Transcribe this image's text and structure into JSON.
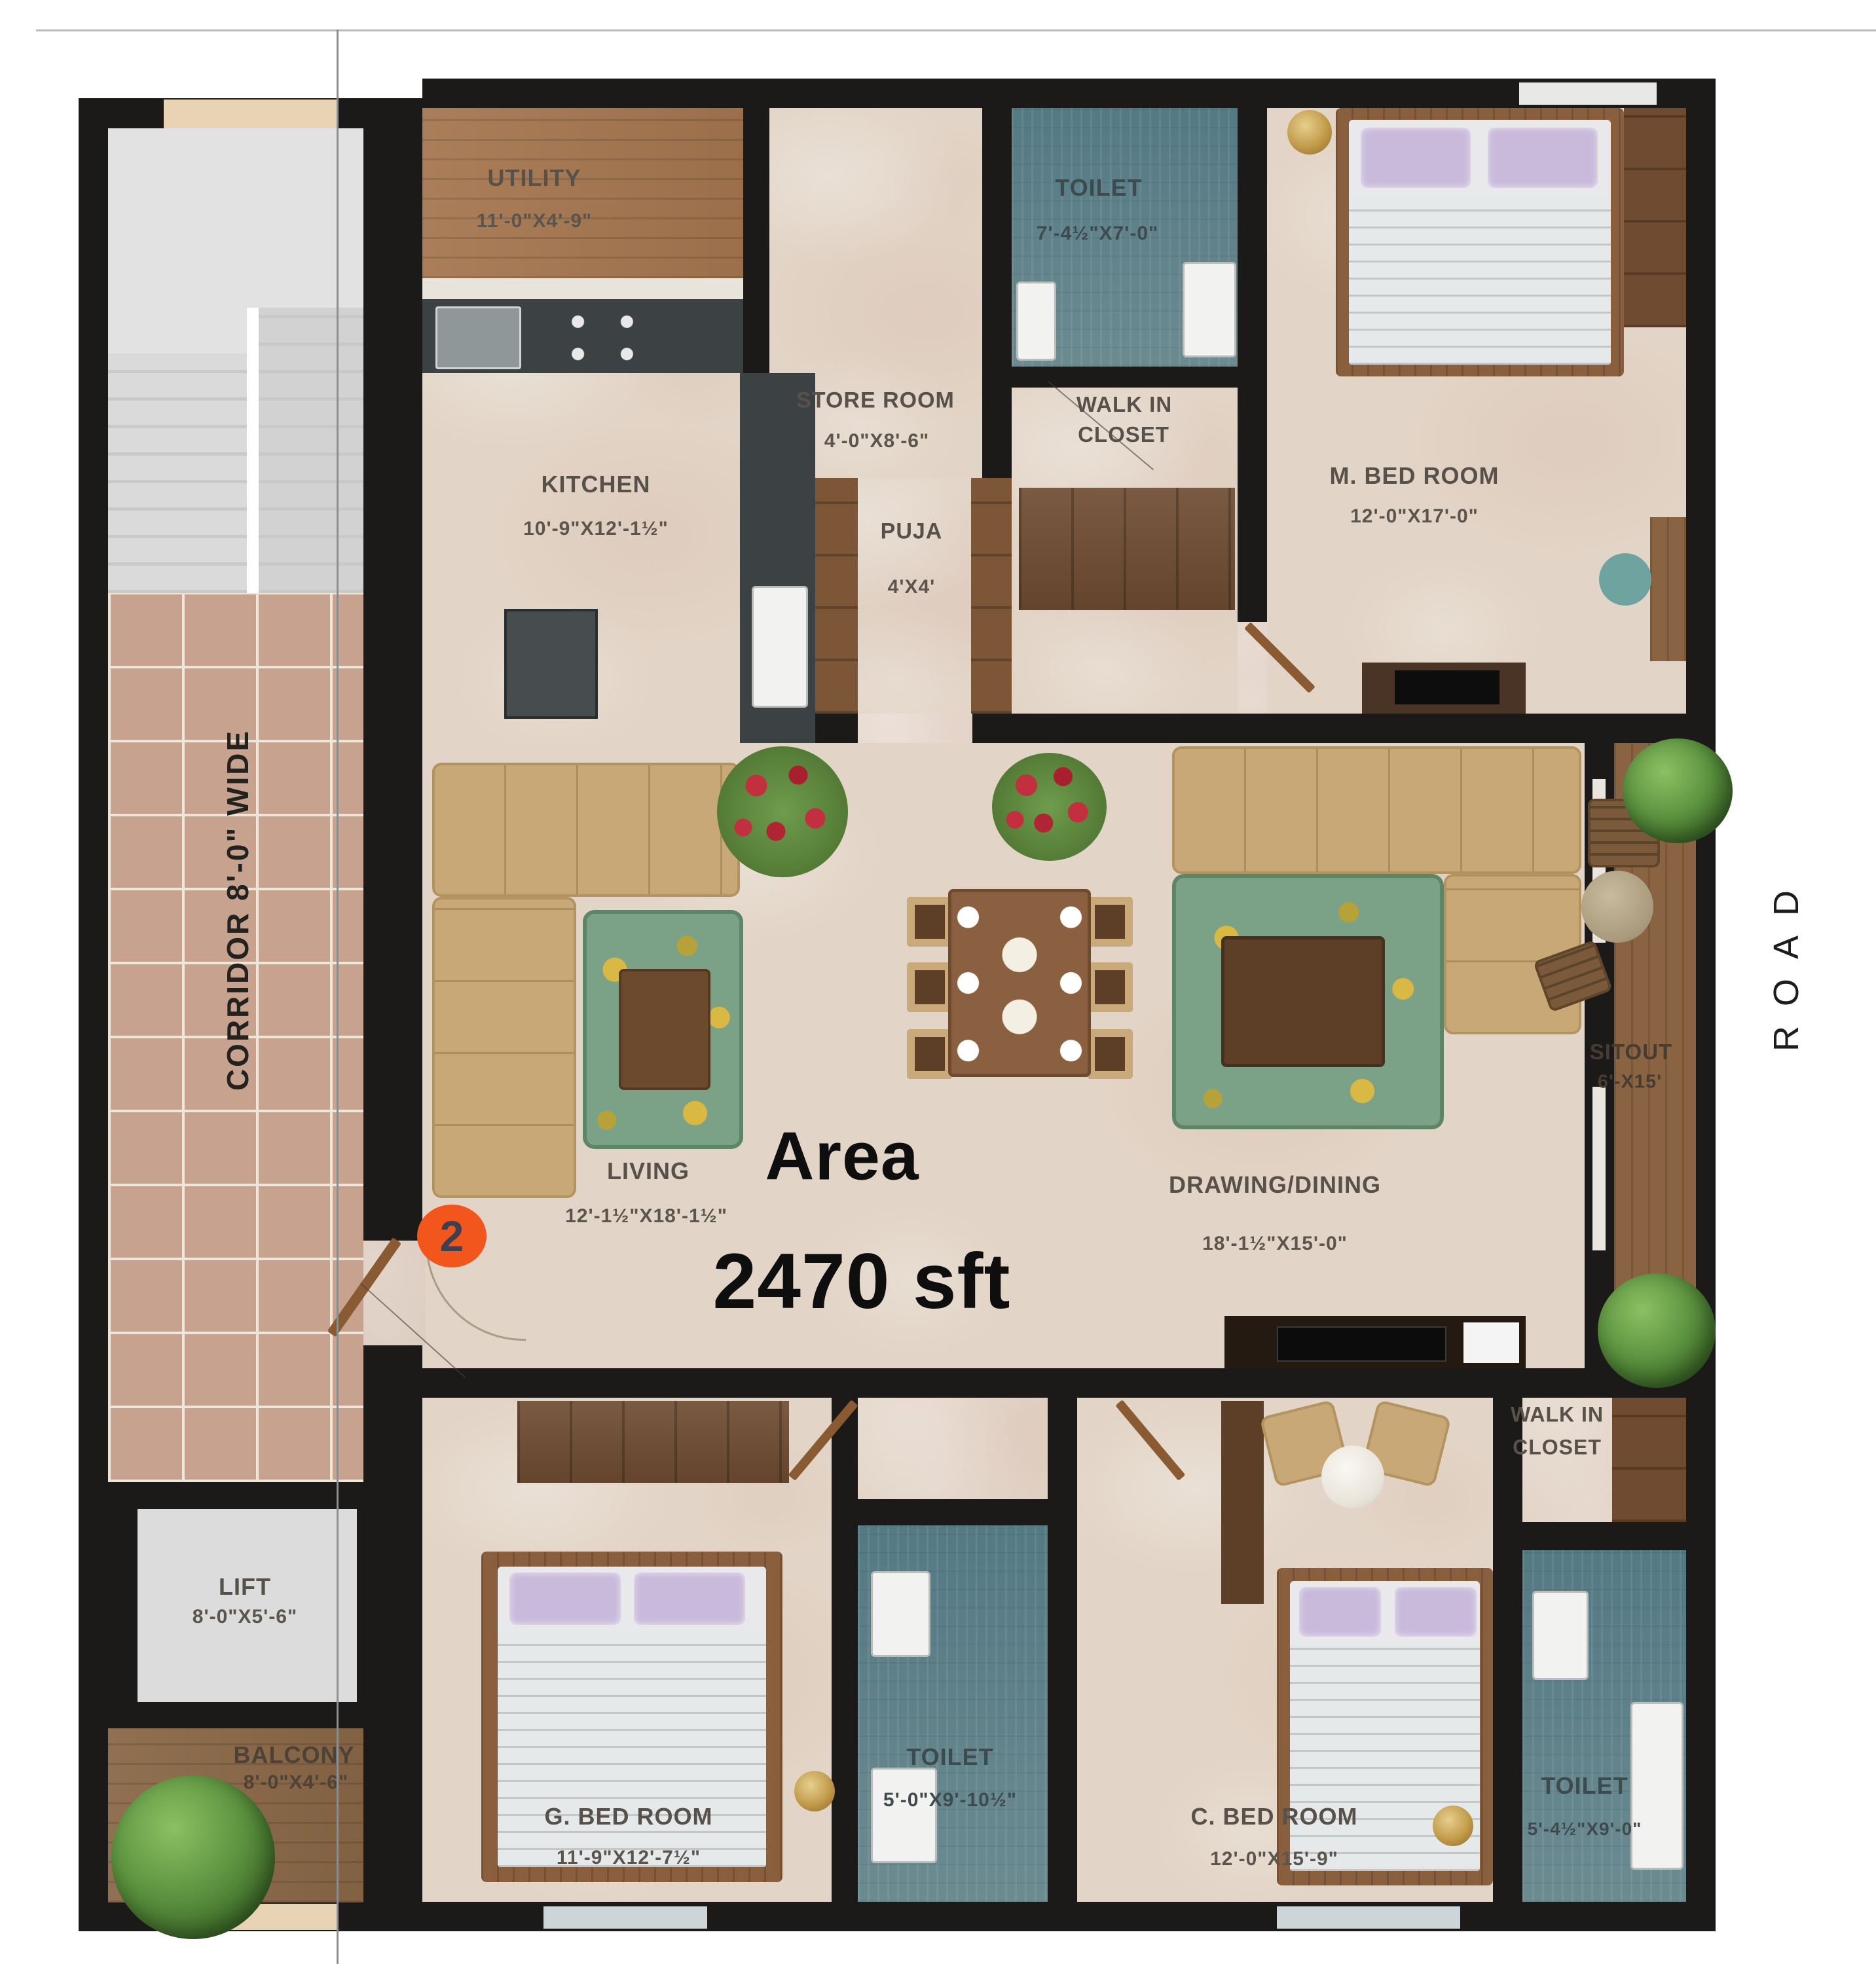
{
  "meta": {
    "area_title": "Area",
    "area_value": "2470 sft",
    "unit_badge": "2",
    "road_label": "ROAD",
    "corridor_label": "CORRIDOR 8'-0\" WIDE"
  },
  "rooms": {
    "utility": {
      "name": "UTILITY",
      "dims": "11'-0\"X4'-9\""
    },
    "store_room": {
      "name": "STORE ROOM",
      "dims": "4'-0\"X8'-6\""
    },
    "toilet_master": {
      "name": "TOILET",
      "dims": "7'-4½\"X7'-0\""
    },
    "m_bed_room": {
      "name": "M. BED ROOM",
      "dims": "12'-0\"X17'-0\""
    },
    "kitchen": {
      "name": "KITCHEN",
      "dims": "10'-9\"X12'-1½\""
    },
    "puja": {
      "name": "PUJA",
      "dims": "4'X4'"
    },
    "walk_in_closet_master": {
      "line1": "WALK IN",
      "line2": "CLOSET"
    },
    "living": {
      "name": "LIVING",
      "dims": "12'-1½\"X18'-1½\""
    },
    "drawing_dining": {
      "name": "DRAWING/DINING",
      "dims": "18'-1½\"X15'-0\""
    },
    "sitout": {
      "name": "SITOUT",
      "dims": "6'-X15'"
    },
    "lift": {
      "name": "LIFT",
      "dims": "8'-0\"X5'-6\""
    },
    "balcony": {
      "name": "BALCONY",
      "dims": "8'-0\"X4'-6\""
    },
    "g_bed_room": {
      "name": "G. BED ROOM",
      "dims": "11'-9\"X12'-7½\""
    },
    "toilet_g_bed": {
      "name": "TOILET",
      "dims": "5'-0\"X9'-10½\""
    },
    "c_bed_room": {
      "name": "C. BED ROOM",
      "dims": "12'-0\"X15'-9\""
    },
    "walk_in_closet_c_bed": {
      "line1": "WALK IN",
      "line2": "CLOSET"
    },
    "toilet_c_bed": {
      "name": "TOILET",
      "dims": "5'-4½\"X9'-0\""
    }
  },
  "colors": {
    "wall": "#1b1a18",
    "marble_floor": "#e2d4c6",
    "toilet_tile": "#68929d",
    "wood_floor": "#9b7149",
    "corridor_tile": "#c7a38f",
    "sofa_tan": "#c8a877",
    "rug_teal": "#7ba287",
    "badge_orange": "#f2561d",
    "label_text": "#57514a"
  }
}
